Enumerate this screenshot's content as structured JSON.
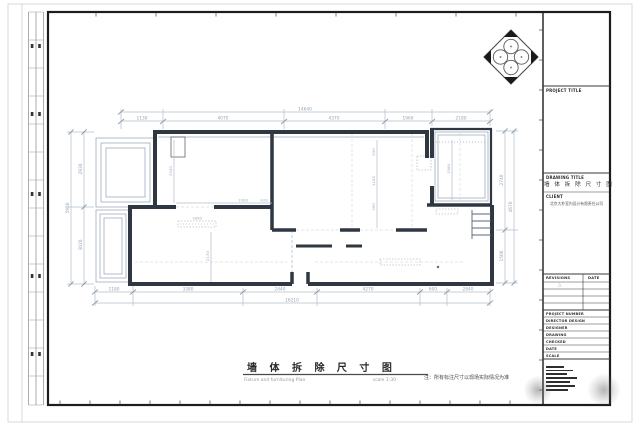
{
  "caption": {
    "title": "墙 体 拆 除 尺 寸 图",
    "subtitle": "Fixture and furnituring Plan",
    "scale": "scale 1:30",
    "note": "注：所有标注尺寸以现场实际情况为准"
  },
  "titleblock": {
    "project_title_label": "PROJECT TITLE",
    "drawing_title_label": "DRAWING TITLE",
    "drawing_title_value": "墙 体 拆 除 尺 寸 图",
    "client_label": "CLIENT",
    "client_value": "北京大朴室内设计有限责任公司",
    "revision_label": "REVISIONS",
    "revision_date_label": "DATE",
    "revision_mark": "△",
    "fields": [
      {
        "label": "PROJECT NUMBER"
      },
      {
        "label": "DIRECTOR DESIGN"
      },
      {
        "label": "DESIGNER"
      },
      {
        "label": "DRAWING"
      },
      {
        "label": "CHECKED"
      },
      {
        "label": "DATE"
      },
      {
        "label": "SCALE"
      }
    ]
  },
  "plan": {
    "dims": {
      "top_total": "14640",
      "top_segments": [
        "1130",
        "4070",
        "4370",
        "1960",
        "2180"
      ],
      "bottom_segments": [
        "1180",
        "3380",
        "2440",
        "4270",
        "600",
        "2840"
      ],
      "bottom_total": "16210",
      "left_segments": [
        "2930",
        "3020"
      ],
      "left_total": "5950",
      "right_segments": [
        "2740",
        "1500"
      ],
      "right_total": "4670",
      "interior": {
        "a": "1890",
        "b": "1000",
        "c": "420",
        "d": "2540",
        "e": "2130",
        "f": "1580",
        "g": "630",
        "h": "1185",
        "i": "390"
      }
    }
  }
}
